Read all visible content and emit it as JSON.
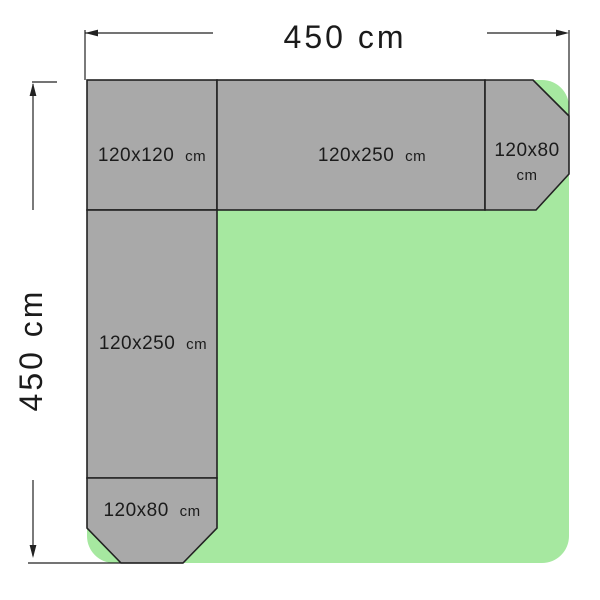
{
  "diagram": {
    "width_label": "450 cm",
    "height_label": "450 cm",
    "colors": {
      "area_green": "#a6e8a0",
      "piece_gray": "#a9a9a9",
      "line": "#222222"
    },
    "pieces": [
      {
        "name": "top-left-square",
        "label": "120x120",
        "unit": "cm"
      },
      {
        "name": "top-rectangle",
        "label": "120x250",
        "unit": "cm"
      },
      {
        "name": "right-end-piece",
        "label": "120x80",
        "unit": "cm"
      },
      {
        "name": "left-rectangle",
        "label": "120x250",
        "unit": "cm"
      },
      {
        "name": "bottom-end-piece",
        "label": "120x80",
        "unit": "cm"
      }
    ]
  }
}
